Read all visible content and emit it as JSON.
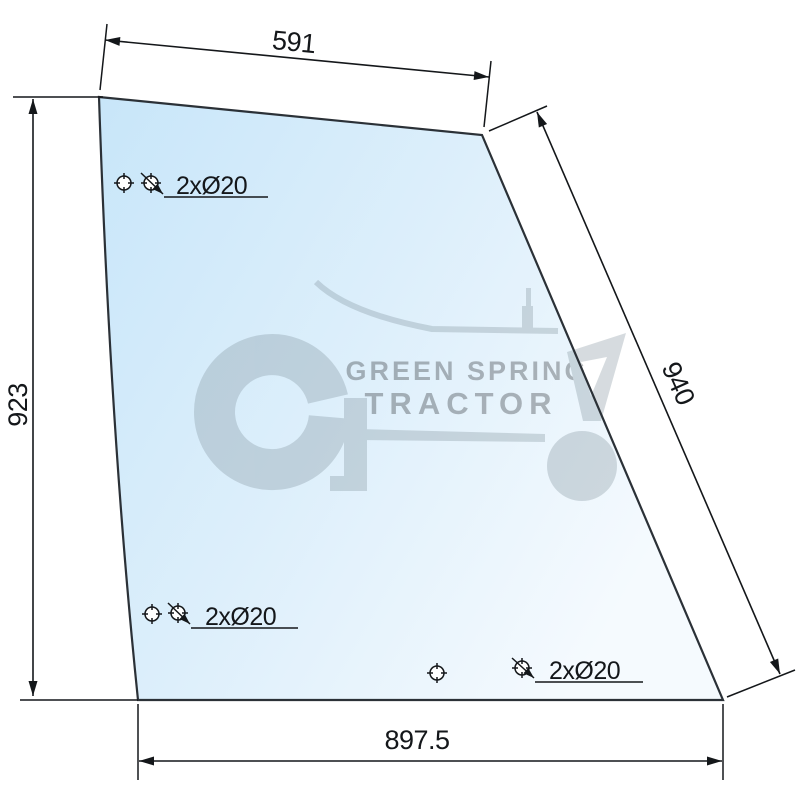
{
  "diagram": {
    "type": "technical-drawing",
    "dimensions": {
      "top": {
        "label": "591"
      },
      "left": {
        "label": "923"
      },
      "right": {
        "label": "940"
      },
      "bottom": {
        "label": "897.5"
      }
    },
    "holes": {
      "top_left_label": "2xØ20",
      "bottom_left_label": "2xØ20",
      "bottom_right_label": "2xØ20"
    },
    "watermark": {
      "line1": "GREEN SPRING",
      "line2": "TRACTOR"
    },
    "colors": {
      "glass_gradient_start": "#c8e6f9",
      "glass_gradient_mid": "#ddeffb",
      "glass_gradient_end": "#f5fafe",
      "outline": "#2b3137",
      "dimension": "#14171a",
      "watermark": "#7a8c96"
    }
  }
}
